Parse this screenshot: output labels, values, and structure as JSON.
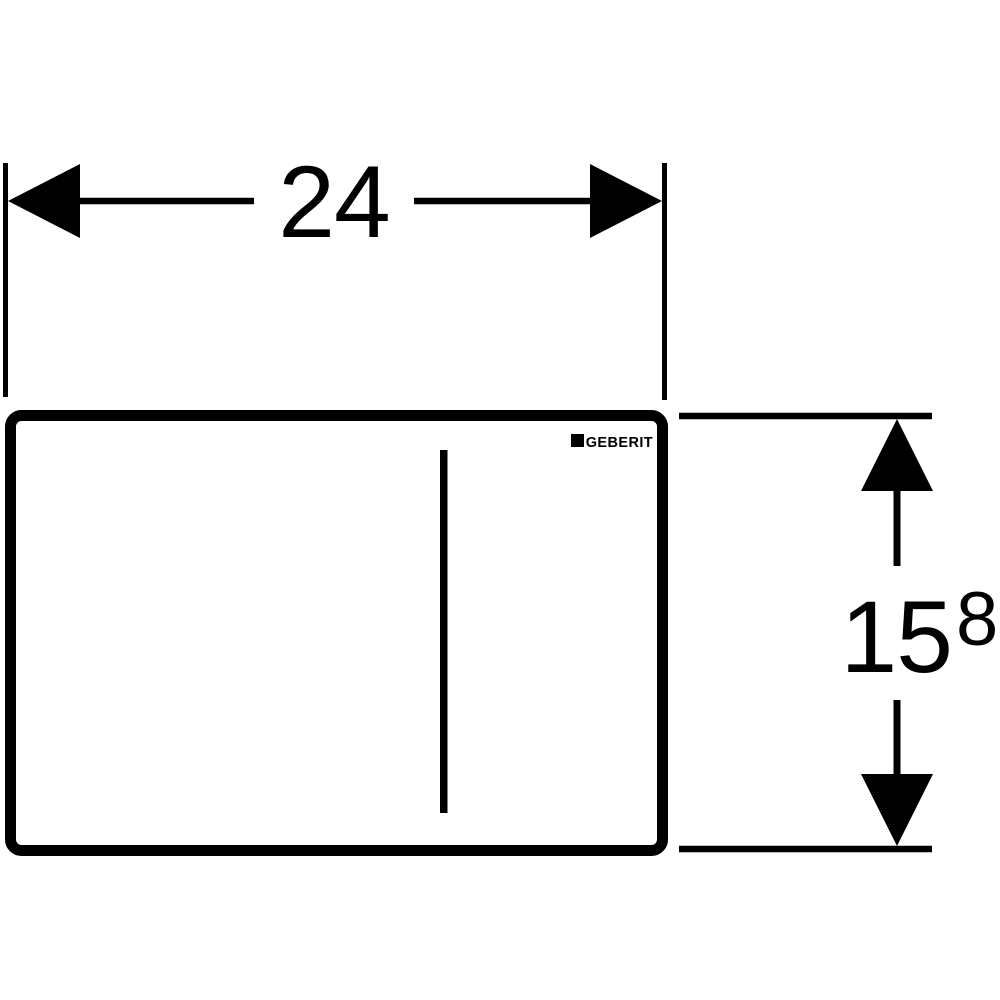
{
  "page": {
    "background": "#ffffff",
    "ink": "#000000",
    "kind": "technical-dimension-drawing",
    "subject": "flush-plate-front-view"
  },
  "plate": {
    "brand_logo": "GEBERIT"
  },
  "dimensions": {
    "width": {
      "label": "24"
    },
    "height": {
      "label": "15",
      "superscript": "8"
    }
  }
}
